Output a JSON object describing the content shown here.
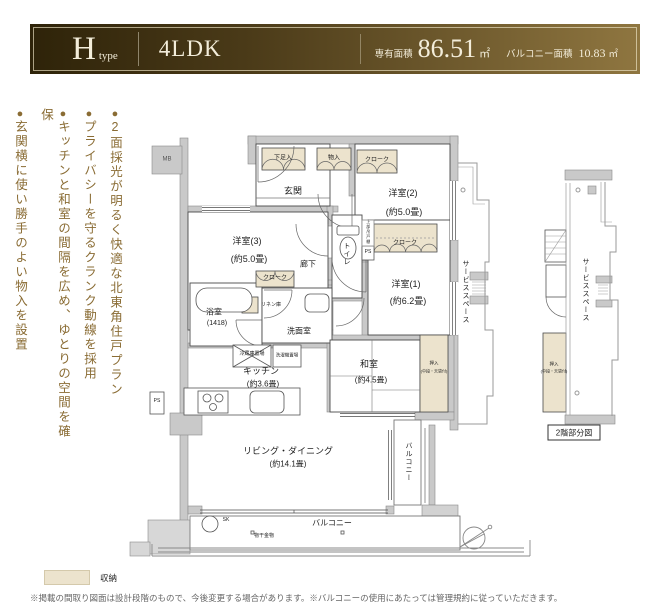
{
  "header": {
    "type_letter": "H",
    "type_suffix": "type",
    "layout": "4LDK",
    "area_label": "専有面積",
    "area_value": "86.51",
    "area_unit": "㎡",
    "balcony_label": "バルコニー面積",
    "balcony_value": "10.83",
    "balcony_unit": "㎡"
  },
  "features": {
    "bullet": "●",
    "items": [
      "2面採光が明るく快適な北東角住戸プラン",
      "プライバシーを守るクランク動線を採用",
      "キッチンと和室の間隔を広め、ゆとりの空間を確保",
      "玄関横に使い勝手のよい物入を設置"
    ]
  },
  "plan": {
    "rooms": {
      "genkan": "玄関",
      "yoshitsu3": "洋室(3)",
      "yoshitsu3_size": "(約5.0畳)",
      "yoshitsu2": "洋室(2)",
      "yoshitsu2_size": "(約5.0畳)",
      "yoshitsu1": "洋室(1)",
      "yoshitsu1_size": "(約6.2畳)",
      "toilet": "トイレ",
      "hall": "廊下",
      "bath": "浴室",
      "bath_size": "(1418)",
      "washroom": "洗面室",
      "kitchen": "キッチン",
      "kitchen_size": "(約3.6畳)",
      "washitsu": "和室",
      "washitsu_size": "(約4.5畳)",
      "living": "リビング・ダイニング",
      "living_size": "(約14.1畳)",
      "balcony_bottom": "バルコニー",
      "balcony_right": "バルコニー",
      "service_space": "サービススペース"
    },
    "storage": {
      "shoe": "下足入",
      "mono": "物入",
      "cloak_top": "クローク",
      "cloak3": "クローク",
      "cloak1": "クローク",
      "linen": "リネン庫",
      "oshiire": "押入",
      "oshiire_note": "(中段・天袋付)"
    },
    "fixtures": {
      "mb": "MB",
      "ps1": "PS",
      "ps2": "PS",
      "sk": "SK",
      "fridge": "冷蔵庫置場",
      "washer": "洗濯機置場",
      "hanger": "物干金物",
      "upper_cabinet": "上部吊戸棚"
    },
    "partial": {
      "title": "2階部分図",
      "service_space": "サービススペース",
      "oshiire": "押入",
      "oshiire_note": "(中段・天袋付)"
    }
  },
  "legend": {
    "label": "収納"
  },
  "footnote": "※掲載の間取り図面は設計段階のもので、今後変更する場合があります。※バルコニーの使用にあたっては管理規約に従っていただきます。",
  "colors": {
    "header_dark": "#2e2309",
    "header_light": "#8f7640",
    "accent": "#8a6c34",
    "storage_fill": "#ece3cd",
    "wall": "#c9c9c9"
  }
}
